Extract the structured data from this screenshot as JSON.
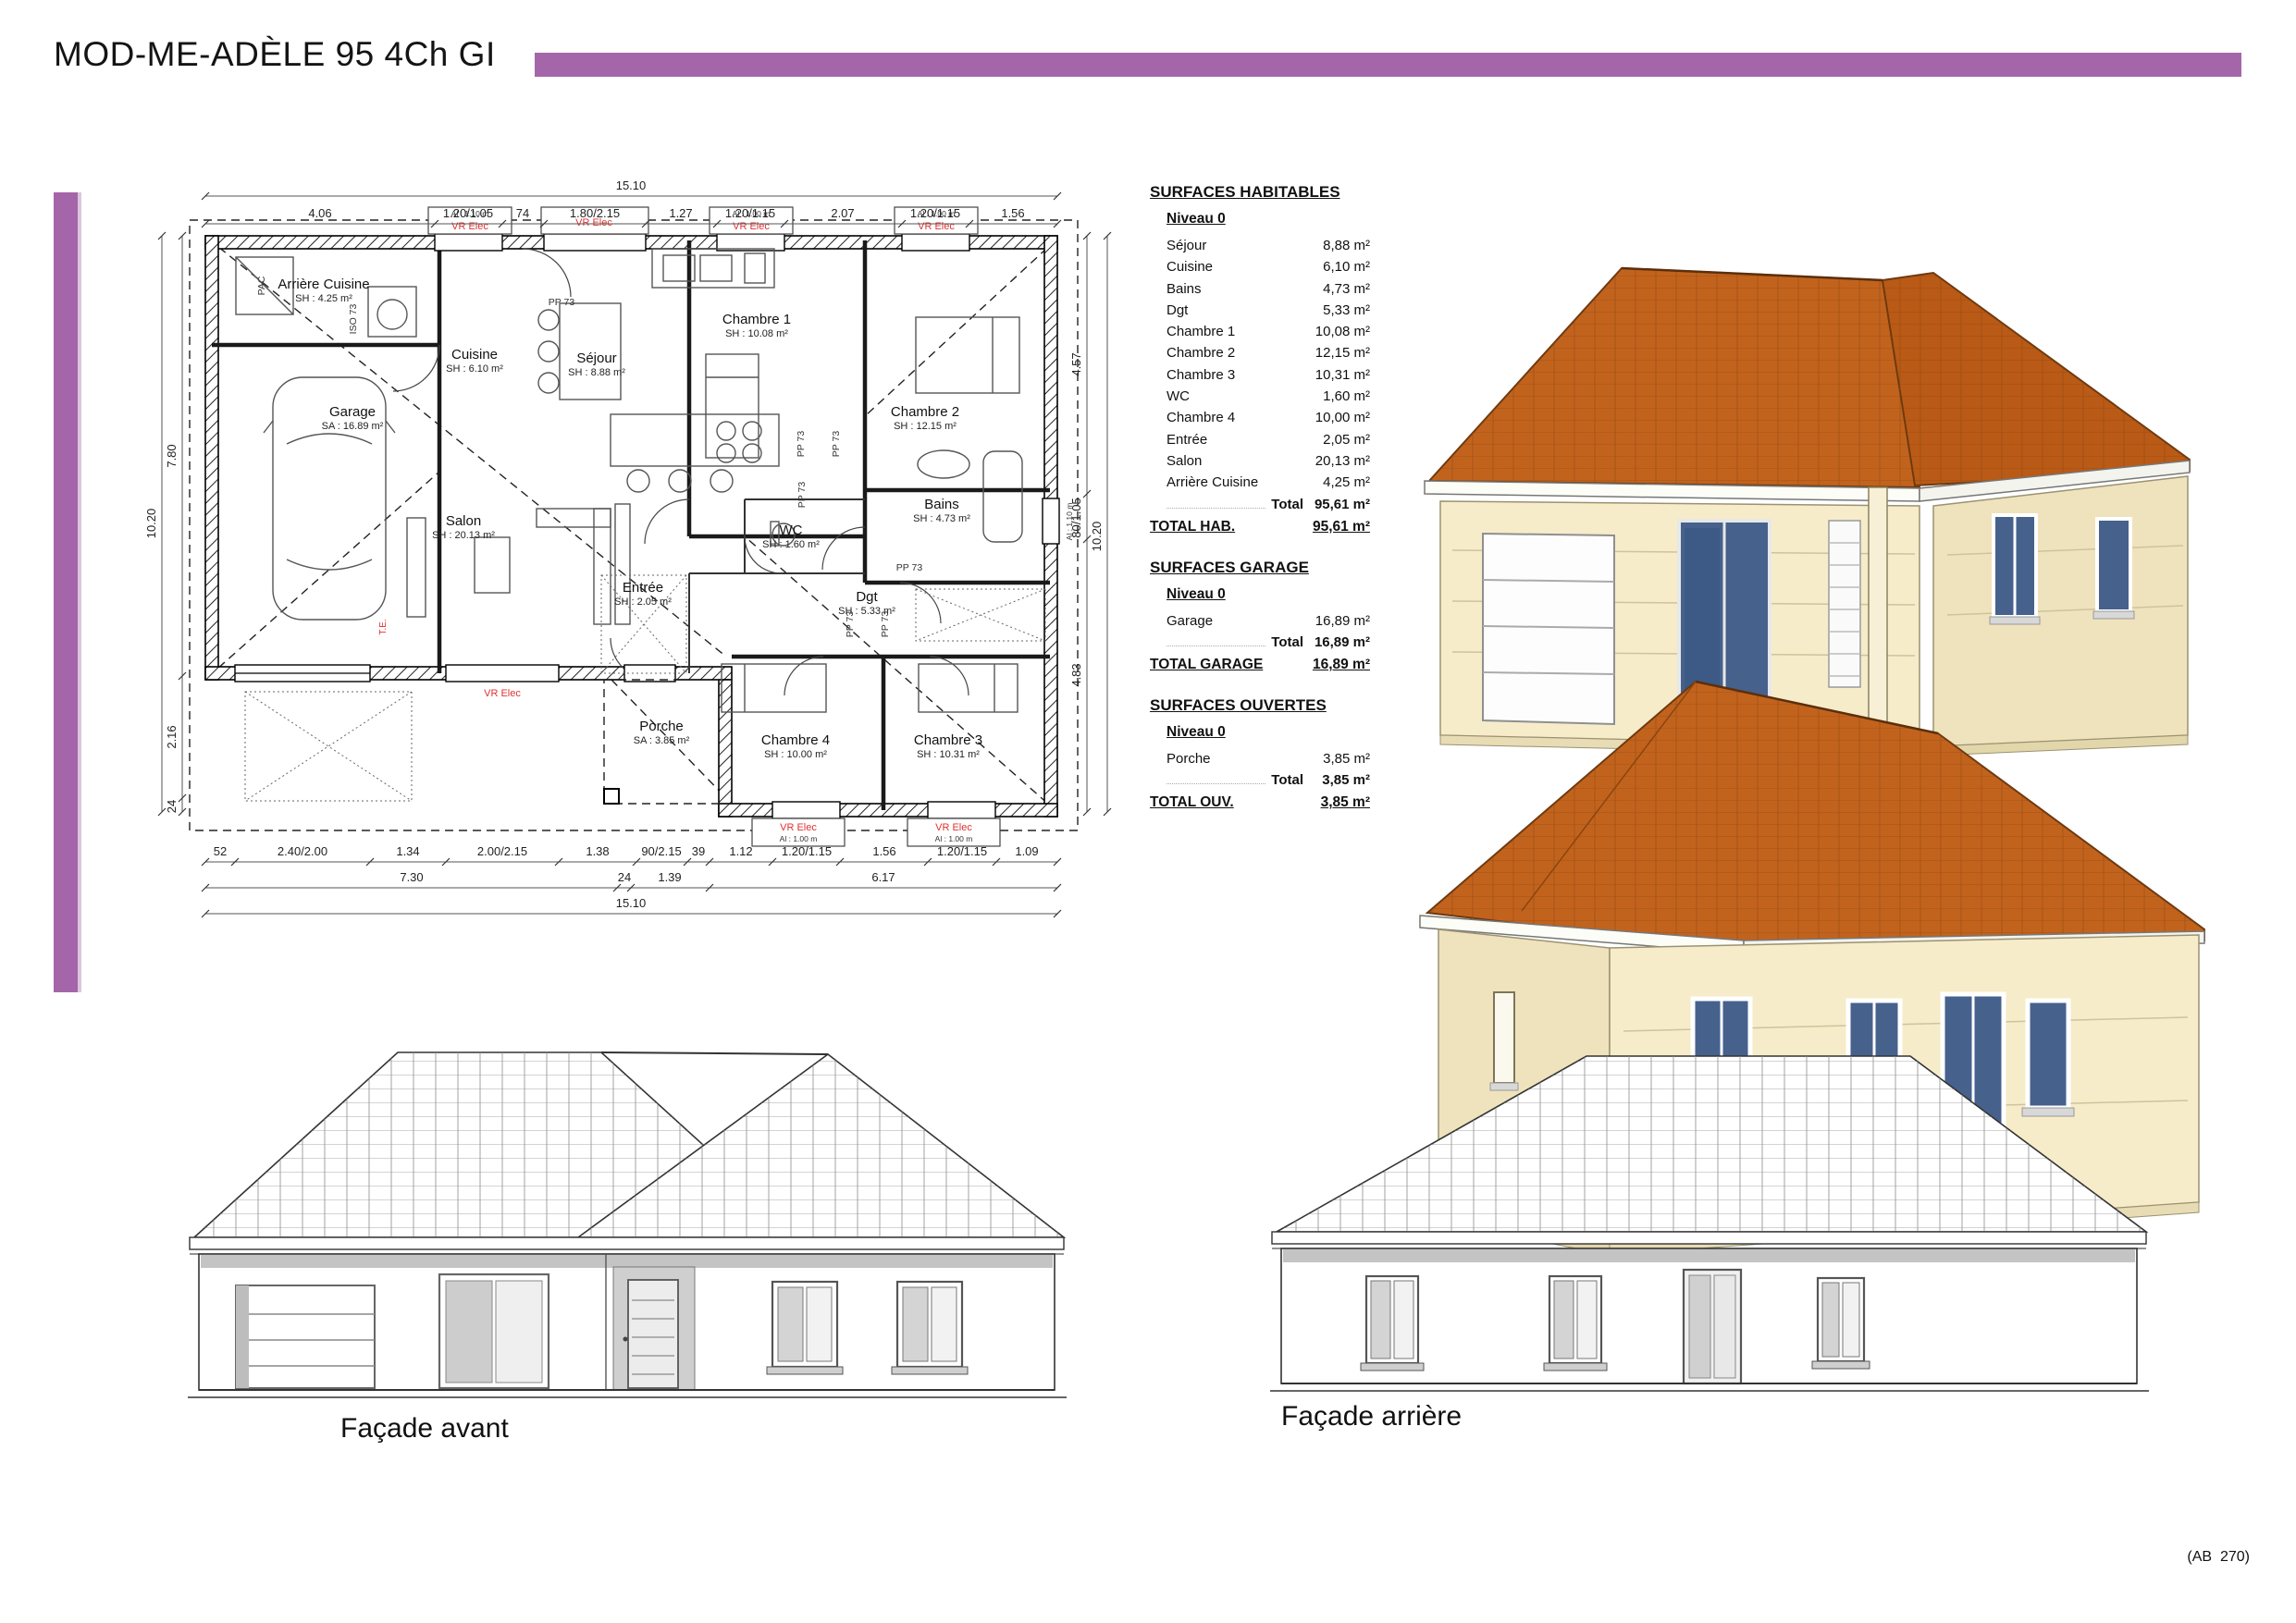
{
  "header": {
    "title": "MOD-ME-ADÈLE 95 4Ch GI"
  },
  "footer": {
    "ref": "(AB  270)"
  },
  "colors": {
    "accent": "#a565a9",
    "red_label": "#e03131",
    "roof": "#c2631d",
    "roof_line": "#8a4510",
    "wall_cream": "#f6ecca",
    "wall_shade": "#efe3bd",
    "glass": "#46618c"
  },
  "plan": {
    "rooms": [
      {
        "name": "Arrière Cuisine",
        "area": "SH : 4.25 m²"
      },
      {
        "name": "Cuisine",
        "area": "SH : 6.10 m²"
      },
      {
        "name": "Séjour",
        "area": "SH : 8.88 m²"
      },
      {
        "name": "Garage",
        "area": "SA : 16.89 m²"
      },
      {
        "name": "Salon",
        "area": "SH : 20.13 m²"
      },
      {
        "name": "Entrée",
        "area": "SH : 2.05 m²"
      },
      {
        "name": "Chambre 1",
        "area": "SH : 10.08 m²"
      },
      {
        "name": "Chambre 2",
        "area": "SH : 12.15 m²"
      },
      {
        "name": "Bains",
        "area": "SH : 4.73 m²"
      },
      {
        "name": "WC",
        "area": "SH : 1.60 m²"
      },
      {
        "name": "Dgt",
        "area": "SH : 5.33 m²"
      },
      {
        "name": "Porche",
        "area": "SA : 3.85 m²"
      },
      {
        "name": "Chambre 4",
        "area": "SH : 10.00 m²"
      },
      {
        "name": "Chambre 3",
        "area": "SH : 10.31 m²"
      }
    ],
    "annotations": {
      "vr_elec": "VR Elec",
      "al_100": "Al : 1.00 m",
      "al_110": "Al : 1.10 m",
      "pp73": "PP 73",
      "iso73": "ISO 73",
      "pac": "PAC",
      "te": "T.E."
    },
    "dims": {
      "top_total": "15.10",
      "top": [
        "4.06",
        "1.20/1.05",
        "74",
        "1.80/2.15",
        "1.27",
        "1.20/1.15",
        "2.07",
        "1.20/1.15",
        "1.56"
      ],
      "bottom_r1": [
        "52",
        "2.40/2.00",
        "1.34",
        "2.00/2.15",
        "1.38",
        "90/2.15",
        "39",
        "1.12",
        "1.20/1.15",
        "1.56",
        "1.20/1.15",
        "1.09"
      ],
      "bottom_r2": [
        "7.30",
        "24",
        "1.39",
        "6.17"
      ],
      "bottom_total": "15.10",
      "left_outer": "10.20",
      "left_inner": [
        "7.80",
        "2.16",
        "24"
      ],
      "right_inner": [
        "4.57",
        "80/1.05",
        "4.83"
      ],
      "right_outer": "10.20"
    }
  },
  "tables": [
    {
      "title": "SURFACES HABITABLES",
      "level": "Niveau 0",
      "rows": [
        {
          "label": "Séjour",
          "value": "8,88 m²"
        },
        {
          "label": "Cuisine",
          "value": "6,10 m²"
        },
        {
          "label": "Bains",
          "value": "4,73 m²"
        },
        {
          "label": "Dgt",
          "value": "5,33 m²"
        },
        {
          "label": "Chambre 1",
          "value": "10,08 m²"
        },
        {
          "label": "Chambre 2",
          "value": "12,15 m²"
        },
        {
          "label": "Chambre 3",
          "value": "10,31 m²"
        },
        {
          "label": "WC",
          "value": "1,60 m²"
        },
        {
          "label": "Chambre 4",
          "value": "10,00 m²"
        },
        {
          "label": "Entrée",
          "value": "2,05 m²"
        },
        {
          "label": "Salon",
          "value": "20,13 m²"
        },
        {
          "label": "Arrière Cuisine",
          "value": "4,25 m²"
        }
      ],
      "total_label": "Total",
      "total_value": "95,61 m²",
      "grand_label": "TOTAL HAB.",
      "grand_value": "95,61 m²"
    },
    {
      "title": "SURFACES GARAGE",
      "level": "Niveau 0",
      "rows": [
        {
          "label": "Garage",
          "value": "16,89 m²"
        }
      ],
      "total_label": "Total",
      "total_value": "16,89 m²",
      "grand_label": "TOTAL GARAGE",
      "grand_value": "16,89 m²"
    },
    {
      "title": "SURFACES OUVERTES",
      "level": "Niveau 0",
      "rows": [
        {
          "label": "Porche",
          "value": "3,85 m²"
        }
      ],
      "total_label": "Total",
      "total_value": "3,85 m²",
      "grand_label": "TOTAL OUV.",
      "grand_value": "3,85 m²"
    }
  ],
  "facades": {
    "front": "Façade avant",
    "rear": "Façade arrière"
  }
}
